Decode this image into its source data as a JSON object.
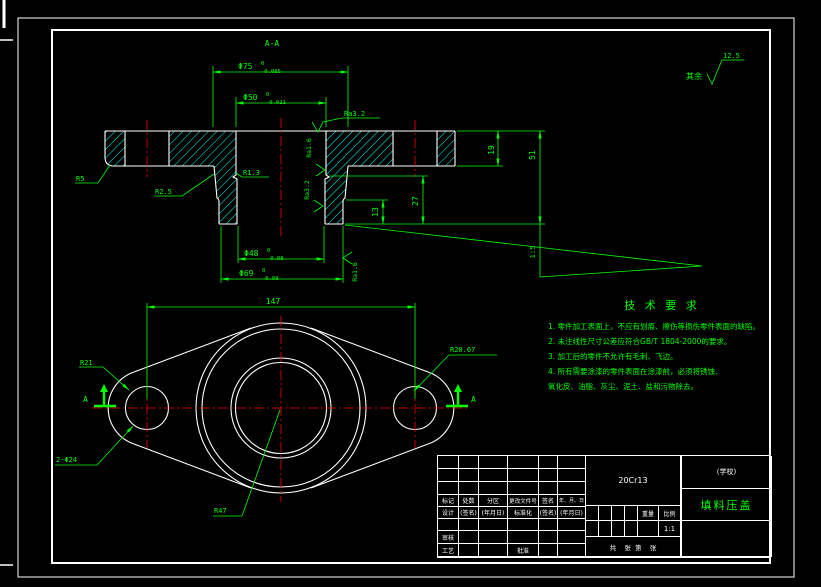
{
  "colors": {
    "line": "#ffffff",
    "dimension": "#00ff00",
    "centerline": "#ff0000",
    "hatch": "#00ffff",
    "background": "#000000"
  },
  "finish_note": {
    "prefix": "其余",
    "value": "12.5"
  },
  "section": {
    "label": "A-A",
    "d75": "Φ75",
    "d75_up": "0",
    "d75_lo": "-0.085",
    "d50": "Φ50",
    "d50_up": "0",
    "d50_lo": "-0.021",
    "d48": "Φ48",
    "d48_up": "0",
    "d48_lo": "-0.08",
    "d69": "Φ69",
    "d69_up": "0",
    "d69_lo": "-0.09",
    "h19": "19",
    "h51": "51",
    "h27": "27",
    "h13": "13",
    "taper": "1:5",
    "r5": "R5",
    "r25": "R2.5",
    "r13": "R1.3",
    "ra32_top": "Ra3.2",
    "ra16_bore": "Ra1.6",
    "ra32_bore": "Ra3.2",
    "ra16_out": "Ra1.6"
  },
  "plan": {
    "dim147": "147",
    "r21": "R21",
    "r2067": "R20.67",
    "holes": "2-Φ24",
    "r47": "R47",
    "mark_left": "A",
    "mark_right": "A"
  },
  "tech": {
    "title": "技 术 要 求",
    "lines": [
      "1. 零件加工表面上，不应有划痕、擦伤等损伤零件表面的缺陷。",
      "2. 未注线性尺寸公差应符合GB/T 1804-2000的要求。",
      "3. 加工后的零件不允许有毛刺、飞边。",
      "4. 所有需要涂漆的零件表面在涂漆前，必须将锈蚀、",
      "氧化皮、油脂、灰尘、泥土、盐和污物除去。"
    ]
  },
  "tb": {
    "rev": [
      "标记",
      "处数",
      "分区",
      "更改文件号",
      "签名",
      "年、月、日"
    ],
    "design": "设计",
    "sign1": "(签名)",
    "date1": "(年月日)",
    "std": "标准化",
    "sign2": "(签名)",
    "date2": "(年月日)",
    "check": "审核",
    "process": "工艺",
    "approve": "批准",
    "material": "20Cr13",
    "org": "(学校)",
    "part": "填料压盖",
    "weight": "重量",
    "scale": "比例",
    "scale_v": "1:1",
    "sheet": "共    张  第    张"
  }
}
